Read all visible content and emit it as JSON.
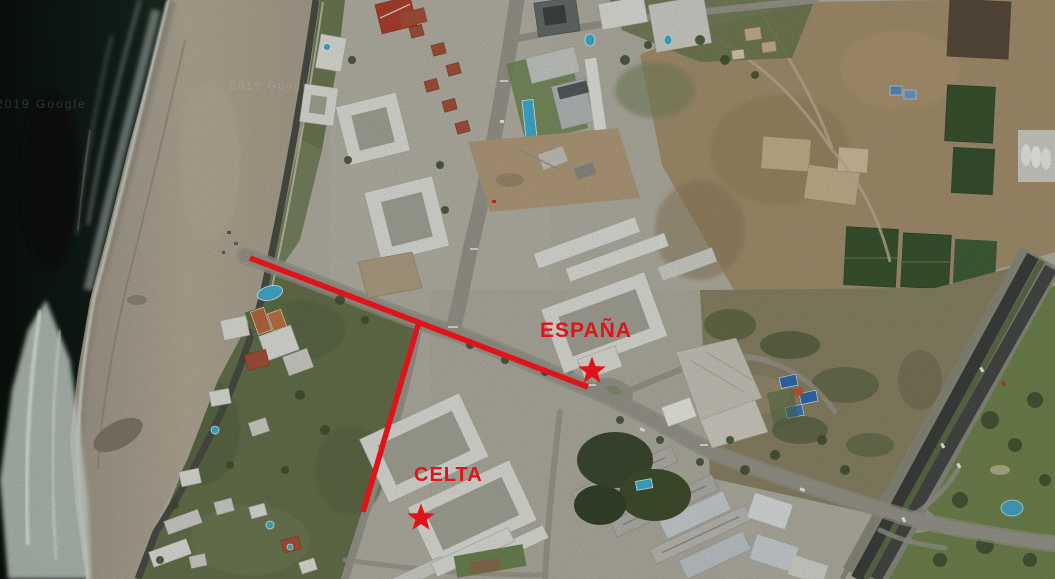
{
  "map": {
    "annotations": {
      "color": "#e01418",
      "espana": {
        "label": "ESPAÑA",
        "marker": "star"
      },
      "celta": {
        "label": "CELTA",
        "marker": "star"
      }
    },
    "watermarks": [
      {
        "text": "2019 Google"
      },
      {
        "text": "2019 Google"
      }
    ]
  },
  "palette": {
    "ocean": "#0d1712",
    "foam": "#d3ddd6",
    "sand": "#b4aa96",
    "urban_ground": "#b5b3a5",
    "vegetation": "#5f6c48",
    "dirt_field": "#a6926f",
    "building_white": "#e3e3dd",
    "pool_blue": "#41b1d4",
    "asphalt": "#4b4e46",
    "red_roof": "#a8523c"
  }
}
